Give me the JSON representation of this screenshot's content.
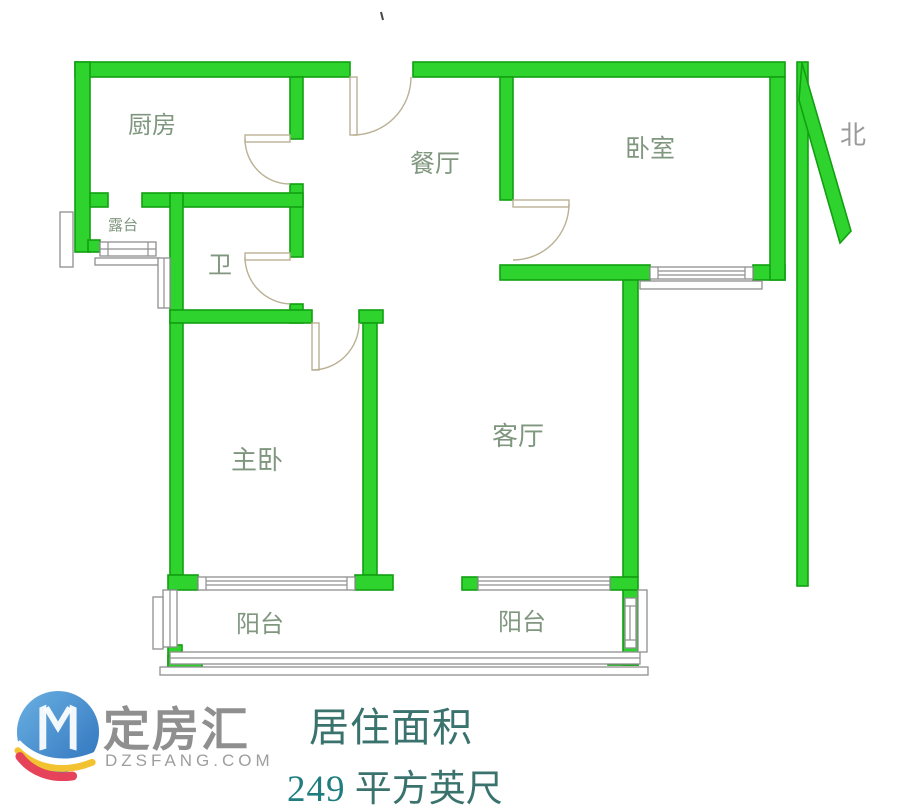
{
  "floor_plan": {
    "labels": {
      "kitchen": "厨房",
      "terrace": "露台",
      "bath": "卫",
      "dining": "餐厅",
      "bedroom": "卧室",
      "master_bedroom": "主卧",
      "living_room": "客厅",
      "balcony_left": "阳台",
      "balcony_right": "阳台",
      "north": "北"
    },
    "colors": {
      "wall_green": "#2ed32e",
      "wall_edge_green": "#12a012",
      "room_label_green": "#80977f",
      "fixture_line_gray": "#8f8f8f",
      "door_line_tan": "#b9b194",
      "north_label_gray": "#9a9a9a"
    }
  },
  "footer": {
    "brand": {
      "name": "定房汇",
      "website": "DZSFANG.COM"
    },
    "area": {
      "title": "居住面积",
      "value": "249",
      "unit": "平方英尺"
    },
    "colors": {
      "brand_gray": "#8f8f8f",
      "area_teal": "#3a736e",
      "value_teal": "#1f7d80",
      "logo_blue": "#3f85c9",
      "logo_yellow": "#f2c230",
      "logo_red": "#e6425a"
    }
  }
}
